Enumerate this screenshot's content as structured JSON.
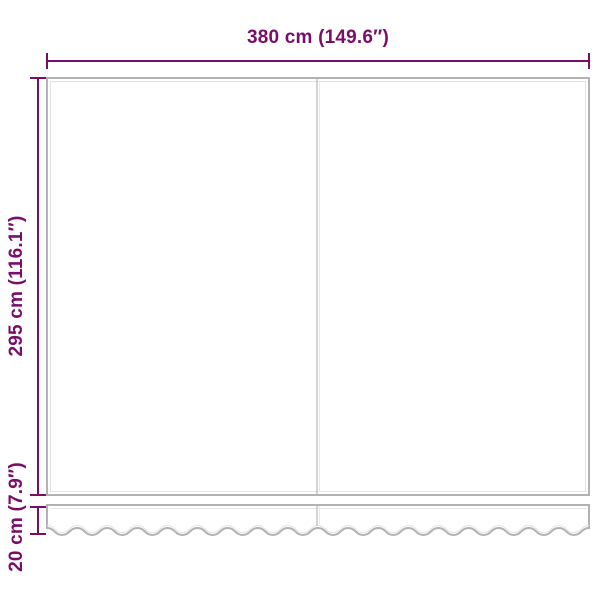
{
  "diagram": {
    "description": "awning-replacement-fabric-dimension-diagram",
    "labels": {
      "width": "380 cm (149.6″)",
      "height": "295 cm (116.1″)",
      "valance": "20 cm (7.9″)"
    },
    "colors": {
      "accent": "#7a0d69",
      "outline": "#b2b2b2",
      "outline_light": "#e3e3e3"
    }
  }
}
